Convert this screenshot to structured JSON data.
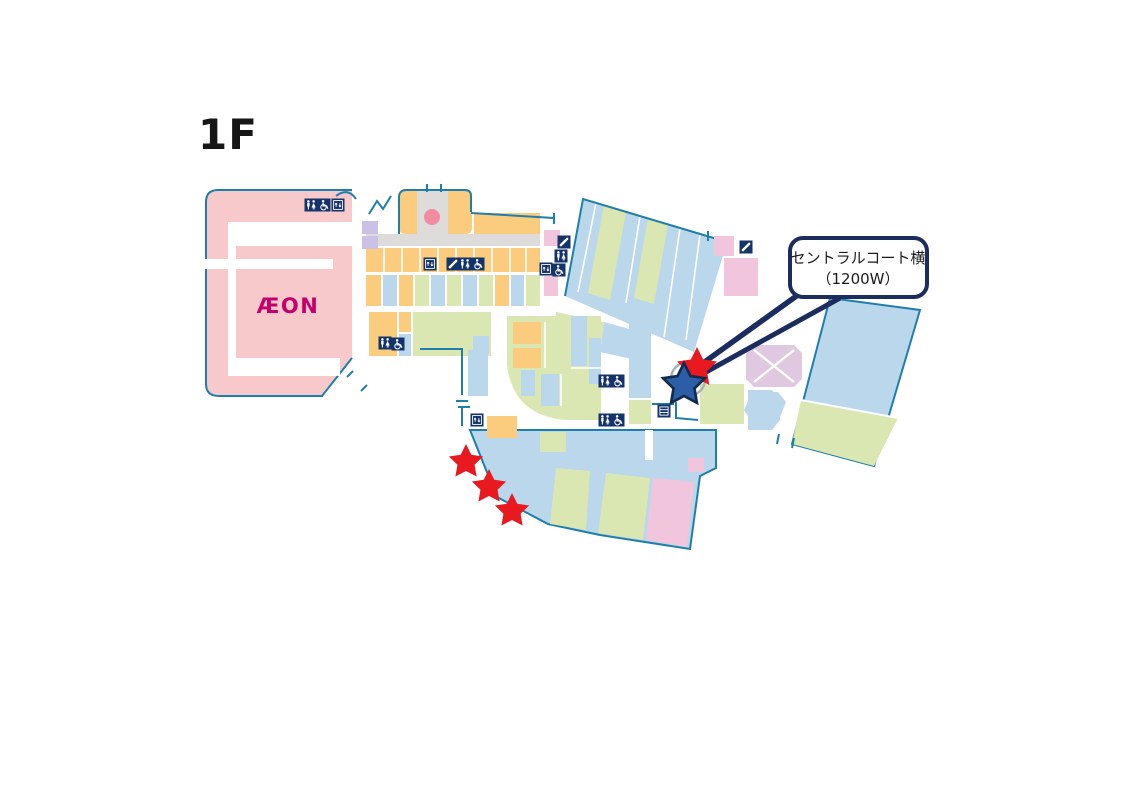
{
  "floor": {
    "label": "1F"
  },
  "anchor_store": {
    "label": "ÆON"
  },
  "callout": {
    "line1": "セントラルコート横",
    "line2": "（1200W）"
  },
  "legend_colors": {
    "department_store_pink": "#F7C9CB",
    "tenant_orange": "#FBCB7E",
    "tenant_blue": "#BAD7EC",
    "tenant_green": "#DBE7B2",
    "tenant_lavender": "#CBC0E5",
    "tenant_pink": "#F1C6DC",
    "court_lavender": "#DFC8E0",
    "corridor_gray": "#DEDCDA",
    "outline_teal": "#1F7FA9",
    "callout_navy": "#1B2D5E",
    "marker_red": "#E8191F",
    "marker_blue": "#2B5EA7",
    "aeon_magenta": "#C4006E",
    "icon_navy": "#14336B",
    "circle_gray": "#A9B0B6",
    "spot_pink": "#F28CA2"
  },
  "markers": {
    "target": [
      {
        "type": "star",
        "color_key": "marker_red",
        "x": 697,
        "y": 368,
        "scale": 2.1,
        "outlined": false
      },
      {
        "type": "star",
        "color_key": "marker_blue",
        "x": 684,
        "y": 385,
        "scale": 2.2,
        "outlined": true
      }
    ],
    "other": [
      {
        "type": "star",
        "color_key": "marker_red",
        "x": 466,
        "y": 462,
        "scale": 1.8,
        "outlined": false
      },
      {
        "type": "star",
        "color_key": "marker_red",
        "x": 489,
        "y": 487,
        "scale": 1.8,
        "outlined": false
      },
      {
        "type": "star",
        "color_key": "marker_red",
        "x": 512,
        "y": 511,
        "scale": 1.8,
        "outlined": false
      }
    ]
  },
  "facility_icons": [
    {
      "type": "toilet",
      "x": 311,
      "y": 205
    },
    {
      "type": "wheelchair",
      "x": 324,
      "y": 205
    },
    {
      "type": "elevator",
      "x": 338,
      "y": 205
    },
    {
      "type": "elevator",
      "x": 430,
      "y": 264
    },
    {
      "type": "phone",
      "x": 453,
      "y": 264
    },
    {
      "type": "toilet",
      "x": 465,
      "y": 264
    },
    {
      "type": "wheelchair",
      "x": 478,
      "y": 264
    },
    {
      "type": "toilet",
      "x": 385,
      "y": 343
    },
    {
      "type": "wheelchair",
      "x": 398,
      "y": 344
    },
    {
      "type": "phone",
      "x": 564,
      "y": 242
    },
    {
      "type": "toilet",
      "x": 561,
      "y": 256
    },
    {
      "type": "elevator",
      "x": 546,
      "y": 269
    },
    {
      "type": "wheelchair",
      "x": 559,
      "y": 270
    },
    {
      "type": "phone",
      "x": 746,
      "y": 247
    },
    {
      "type": "toilet",
      "x": 605,
      "y": 381
    },
    {
      "type": "wheelchair",
      "x": 618,
      "y": 381
    },
    {
      "type": "toilet",
      "x": 605,
      "y": 420
    },
    {
      "type": "wheelchair",
      "x": 618,
      "y": 420
    },
    {
      "type": "elevator",
      "x": 477,
      "y": 420
    },
    {
      "type": "locker",
      "x": 664,
      "y": 411
    }
  ]
}
